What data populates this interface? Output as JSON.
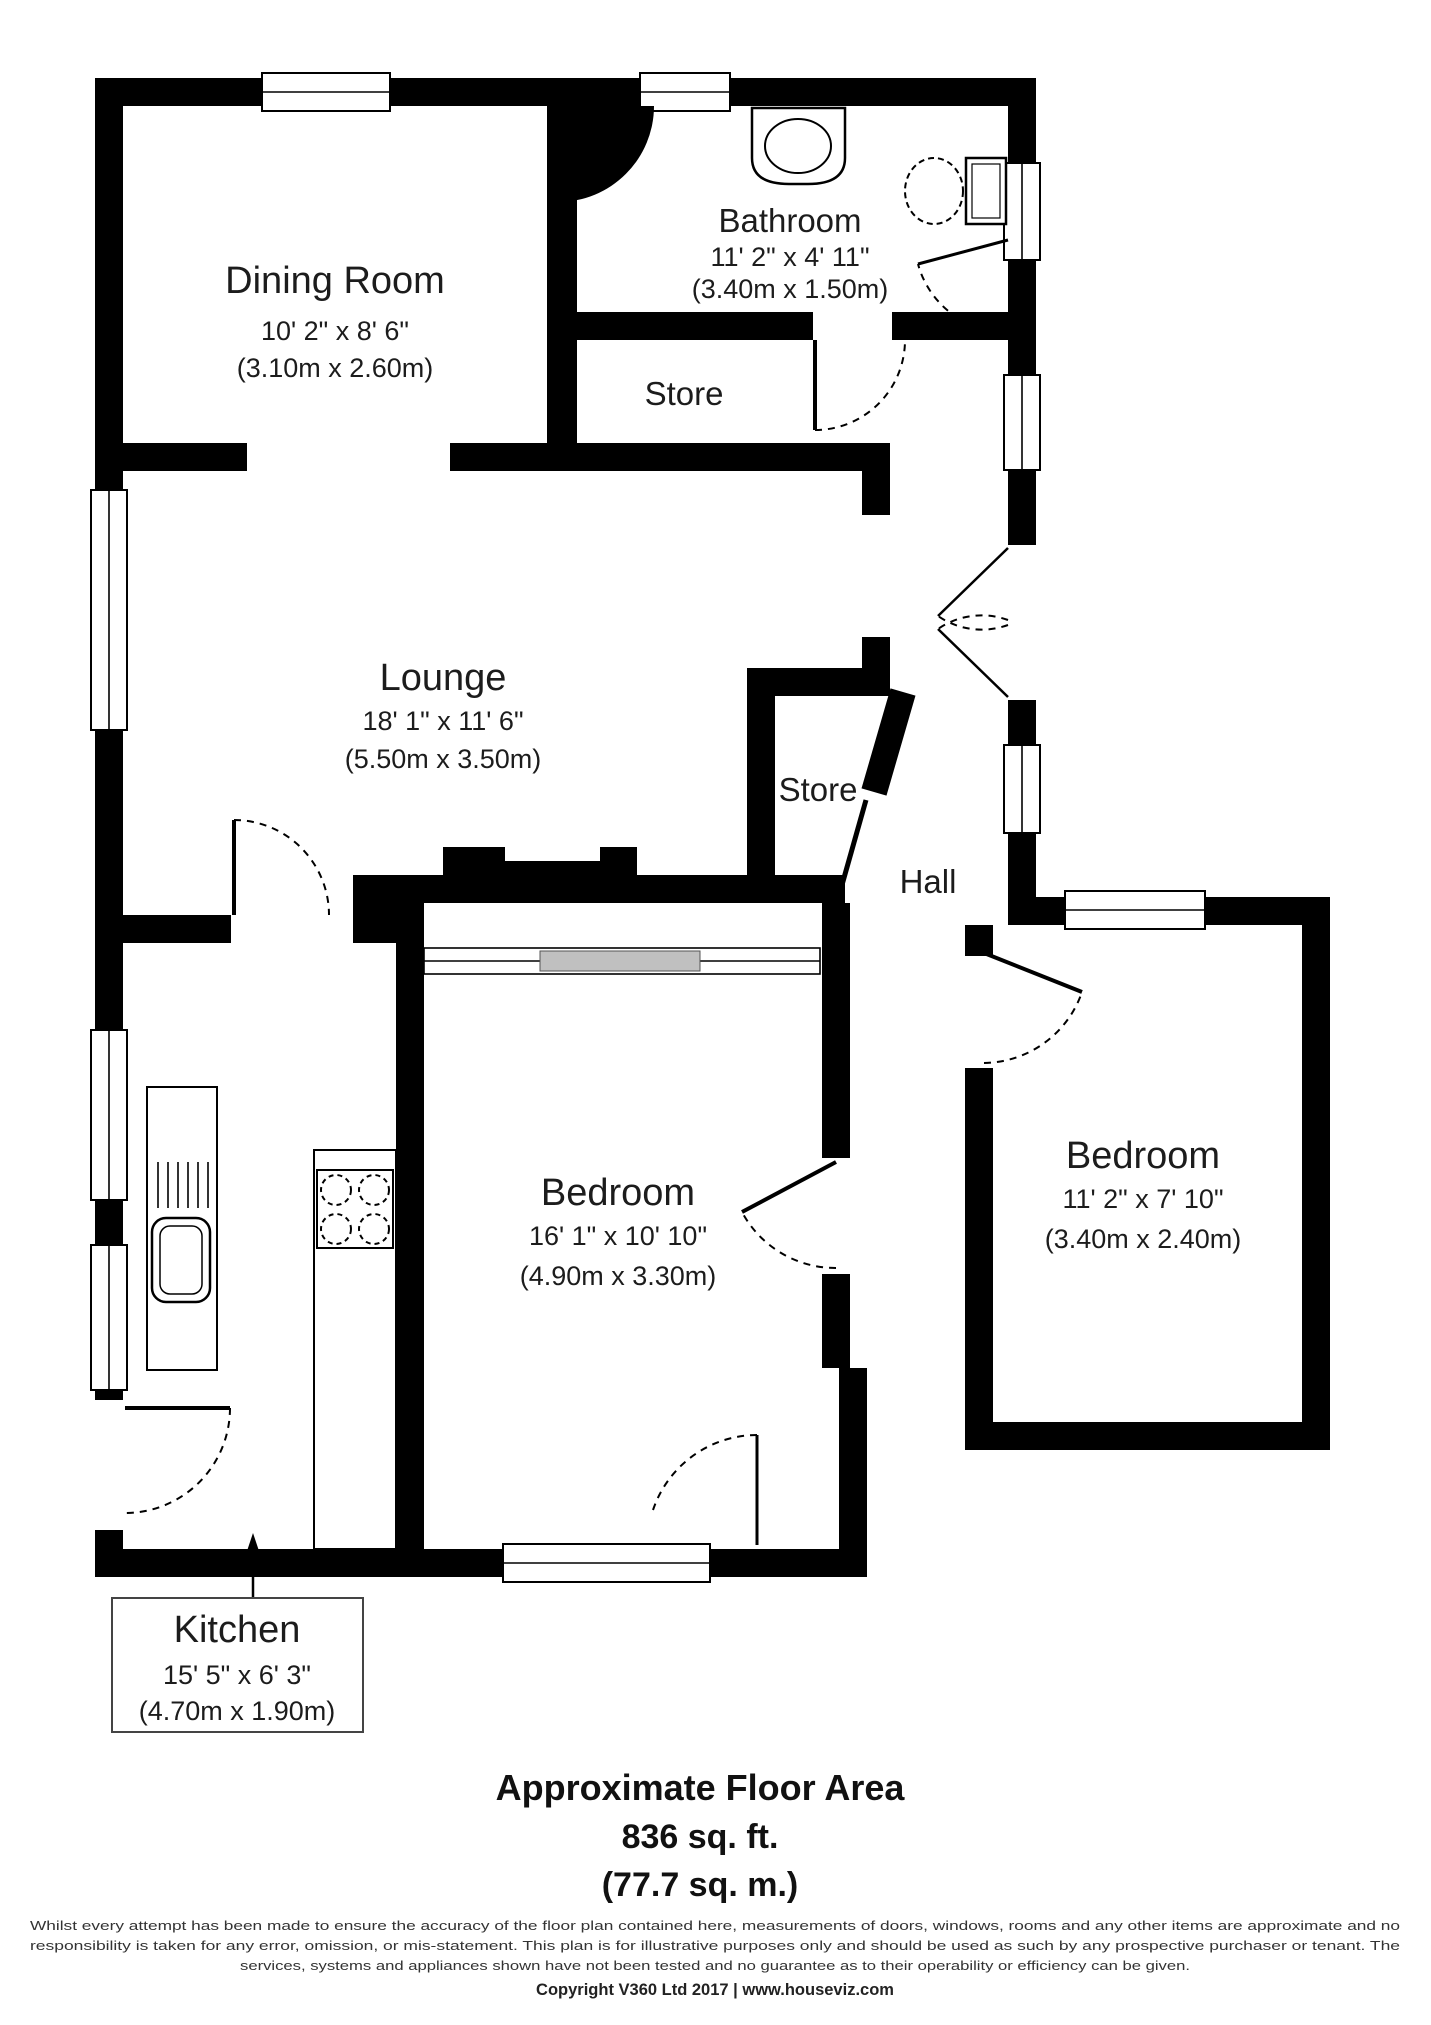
{
  "meta": {
    "type": "estate-agent-floorplan",
    "floor_style": "2d-black-white"
  },
  "colors": {
    "wall": "#000000",
    "background": "#ffffff",
    "text": "#1c1c1c",
    "wardrobe_gray": "#c0c0c0"
  },
  "rooms": {
    "dining": {
      "name": "Dining Room",
      "dims_ft": "10' 2\" x 8' 6\"",
      "dims_m": "(3.10m x 2.60m)"
    },
    "bathroom": {
      "name": "Bathroom",
      "dims_ft": "11' 2\" x 4' 11\"",
      "dims_m": "(3.40m x 1.50m)"
    },
    "store1": {
      "name": "Store"
    },
    "lounge": {
      "name": "Lounge",
      "dims_ft": "18' 1\" x 11' 6\"",
      "dims_m": "(5.50m x 3.50m)"
    },
    "store2": {
      "name": "Store"
    },
    "hall": {
      "name": "Hall"
    },
    "bedroom_main": {
      "name": "Bedroom",
      "dims_ft": "16' 1\" x 10' 10\"",
      "dims_m": "(4.90m x 3.30m)"
    },
    "bedroom_second": {
      "name": "Bedroom",
      "dims_ft": "11' 2\" x 7' 10\"",
      "dims_m": "(3.40m x 2.40m)"
    },
    "kitchen": {
      "name": "Kitchen",
      "dims_ft": "15' 5\" x 6' 3\"",
      "dims_m": "(4.70m x 1.90m)"
    }
  },
  "fixtures": [
    "bath-sink",
    "toilet",
    "kitchen-sink-with-drainer",
    "hob-4-ring",
    "wardrobe",
    "chimney-breast"
  ],
  "footer": {
    "title": "Approximate Floor Area",
    "area_ft": "836 sq. ft.",
    "area_m": "(77.7 sq. m.)",
    "disclaimer": [
      "Whilst every attempt has been made to ensure the accuracy of the floor plan contained here, measurements of doors, windows, rooms and any other items are approximate and no",
      "responsibility is taken for any error, omission, or mis-statement. This plan is for illustrative purposes only and should be used as such by any prospective purchaser or tenant. The",
      "services, systems and appliances shown have not been tested and no guarantee as to their operability or efficiency can be given."
    ],
    "copyright": "Copyright V360 Ltd 2017 | www.houseviz.com"
  }
}
